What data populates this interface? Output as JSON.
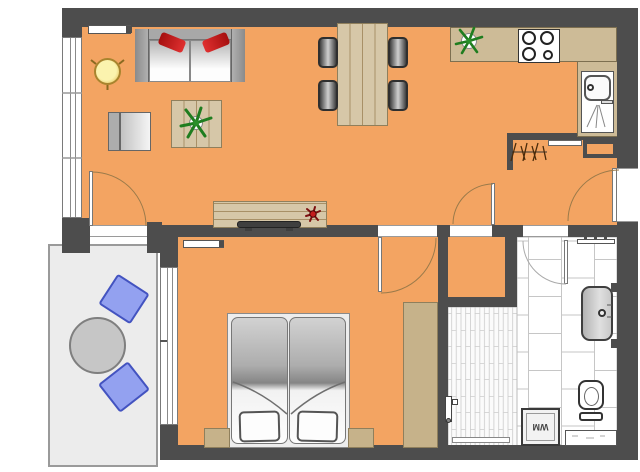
{
  "document": {
    "type": "floor-plan",
    "description": "Top-down architectural floor plan of a two-room apartment with balcony"
  },
  "labels": {
    "washing_machine": "WM"
  },
  "palette": {
    "floor_orange": "#F3A462",
    "wall_gray": "#4D4D4D",
    "wood_tan": "#D6C7A8",
    "wood_dark_tan": "#C6B28A",
    "balcony_floor": "#ECECEC",
    "balcony_chair_blue": "#93A1F0",
    "sofa_pillow_red": "#C41C1C",
    "plant_green": "#1F7D1F",
    "tile_line_gray": "#C6C6C6"
  },
  "rooms": {
    "living_dining": [
      "sofa-with-red-pillows",
      "round-side-table",
      "armchair",
      "coffee-table-with-plant",
      "tv-sideboard-with-flower",
      "dining-table-with-four-chairs",
      "radiator"
    ],
    "kitchen": [
      "l-shaped-counter",
      "stove-four-burners",
      "sink-with-drainer",
      "plant"
    ],
    "hall": [
      "coat-hooks",
      "wall-shelf",
      "installation-shaft",
      "entrance-door"
    ],
    "bedroom": [
      "double-bed",
      "two-pillows",
      "two-nightstands",
      "wardrobe",
      "radiator",
      "window-to-balcony"
    ],
    "storage": [],
    "bathroom": [
      "walk-in-shower",
      "shower-drain",
      "washbasin",
      "toilet",
      "washing-machine",
      "base-cabinet",
      "towel-rail"
    ],
    "balcony": [
      "round-table",
      "two-blue-chairs"
    ]
  }
}
